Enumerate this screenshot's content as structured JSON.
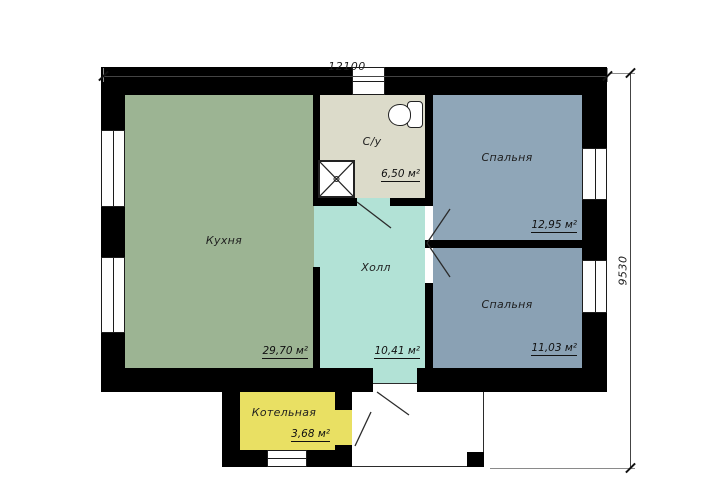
{
  "plan": {
    "dimensions": {
      "width_label": "12100",
      "height_label": "9530"
    },
    "rooms": [
      {
        "id": "kitchen",
        "label": "Кухня",
        "area": "29,70 м²",
        "color": "#9cb493"
      },
      {
        "id": "bathroom",
        "label": "С/у",
        "area": "6,50 м²",
        "color": "#dcdbca"
      },
      {
        "id": "bedroom-top",
        "label": "Спальня",
        "area": "12,95 м²",
        "color": "#8fa6b8"
      },
      {
        "id": "bedroom-bottom",
        "label": "Спальня",
        "area": "11,03 м²",
        "color": "#8aa1b4"
      },
      {
        "id": "hall",
        "label": "Холл",
        "area": "10,41 м²",
        "color": "#b2e2d6"
      },
      {
        "id": "boiler-room",
        "label": "Котельная",
        "area": "3,68 м²",
        "color": "#e9e063"
      }
    ],
    "fixtures": [
      {
        "id": "toilet",
        "name": "toilet-icon"
      },
      {
        "id": "shower",
        "name": "shower-tray-icon"
      }
    ],
    "colors": {
      "walls": "#000000",
      "background": "#ffffff",
      "lines": "#2b2b2b"
    }
  }
}
